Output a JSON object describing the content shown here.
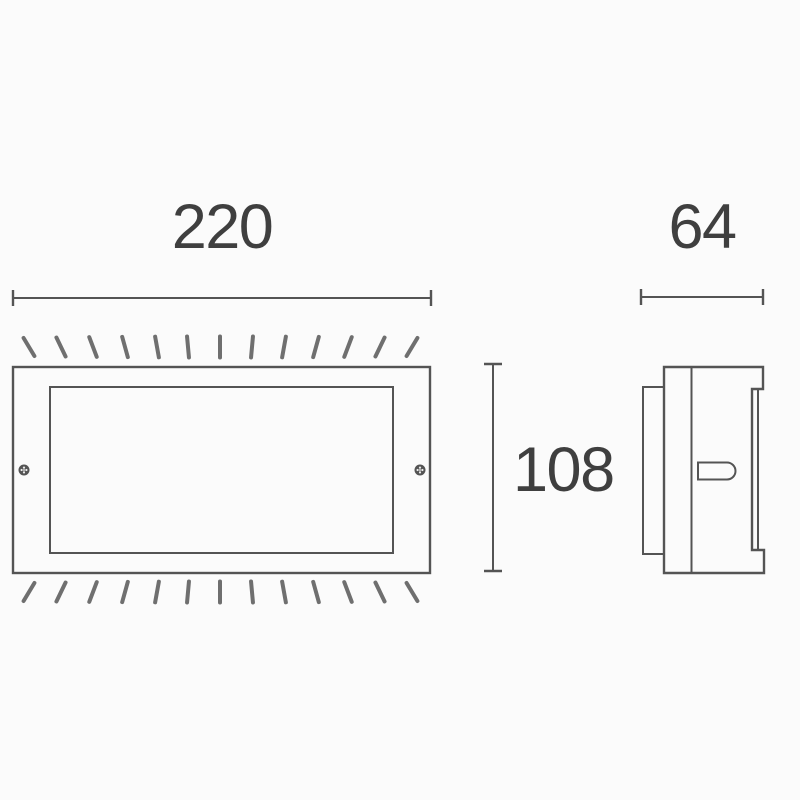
{
  "drawing": {
    "dimensions": {
      "width": {
        "label": "220"
      },
      "depth": {
        "label": "64"
      },
      "height": {
        "label": "108"
      }
    },
    "colors": {
      "background": "#fbfbfb",
      "line": "#545454",
      "hatch": "#6f6f6f",
      "text": "#3f3f3f"
    }
  }
}
